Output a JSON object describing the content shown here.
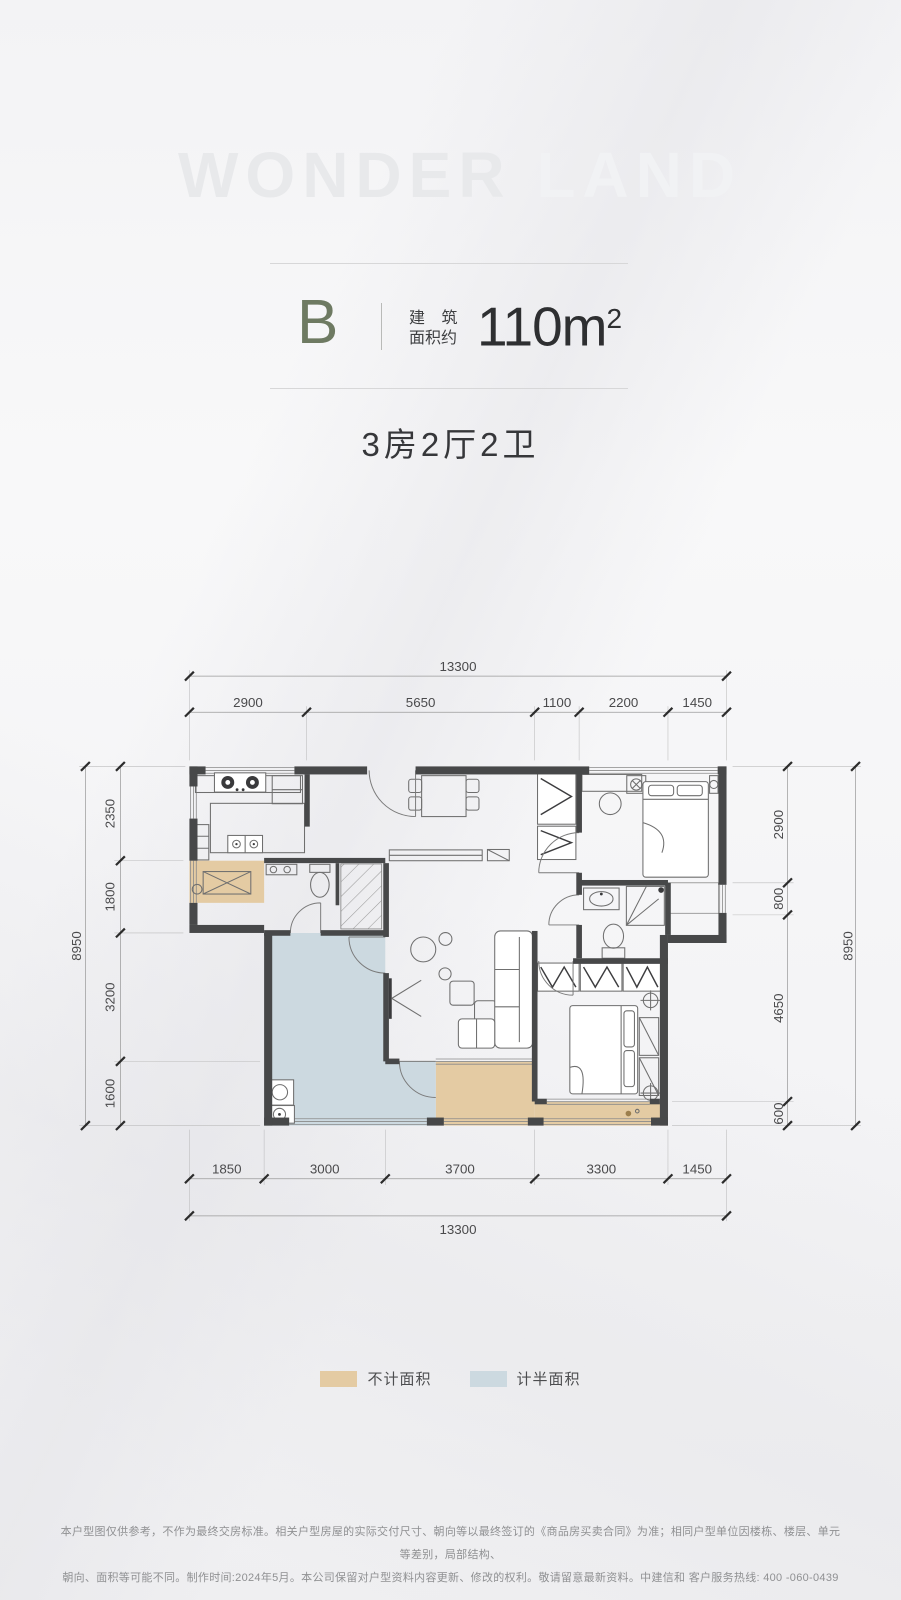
{
  "watermark": {
    "bold": "WONDER",
    "light": "LAND"
  },
  "header": {
    "unit": "B",
    "area_label_line1": "建 筑",
    "area_label_line2": "面积约",
    "area_value": "110m",
    "area_sup": "2"
  },
  "subtitle": "3房2厅2卫",
  "plan": {
    "top_total": "13300",
    "top_segments": [
      "2900",
      "5650",
      "1100",
      "2200",
      "1450"
    ],
    "bottom_segments": [
      "1850",
      "3000",
      "3700",
      "3300",
      "1450"
    ],
    "bottom_total": "13300",
    "left_total": "8950",
    "left_segments": [
      "2350",
      "1800",
      "3200",
      "1600"
    ],
    "right_segments": [
      "2900",
      "800",
      "4650",
      "600"
    ],
    "right_total": "8950",
    "colors": {
      "not_counted": "#e4cba3",
      "half_counted": "#ccd9e0",
      "wall": "#474849"
    }
  },
  "legend": {
    "items": [
      {
        "label": "不计面积",
        "color": "#e4cba3"
      },
      {
        "label": "计半面积",
        "color": "#ccd9e0"
      }
    ]
  },
  "disclaimer": {
    "line1": "本户型图仅供参考，不作为最终交房标准。相关户型房屋的实际交付尺寸、朝向等以最终签订的《商品房买卖合同》为准；相同户型单位因楼栋、楼层、单元等差别，局部结构、",
    "line2": "朝向、面积等可能不同。制作时间:2024年5月。本公司保留对户型资料内容更新、修改的权利。敬请留意最新资料。中建信和 客户服务热线: 400 -060-0439"
  }
}
